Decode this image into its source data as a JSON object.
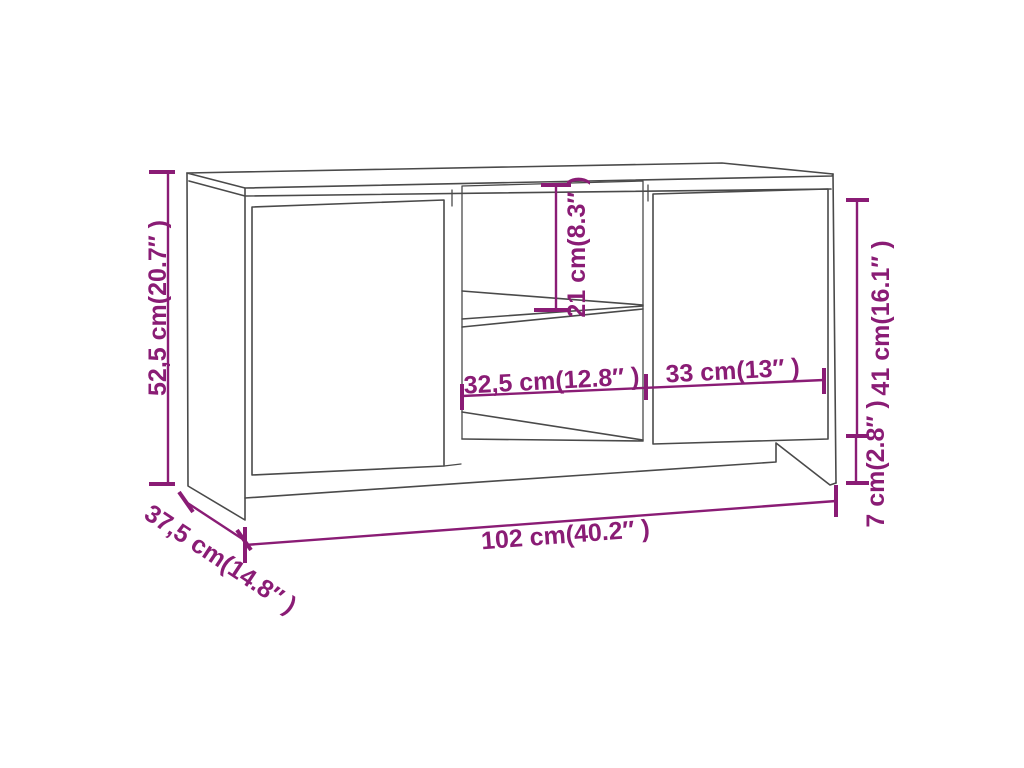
{
  "diagram": {
    "kind": "furniture-dimension-line-drawing",
    "accent_color": "#8A1C75",
    "outline_color": "#4A4A4A",
    "background_color": "#FFFFFF",
    "labels": {
      "height": "52,5 cm(20.7″ )",
      "depth": "37,5 cm(14.8″ )",
      "width": "102 cm(40.2″ )",
      "open_shelf_height": "21 cm(8.3″ )",
      "open_shelf_width": "32,5 cm(12.8″ )",
      "door_width": "33 cm(13″ )",
      "door_height": "41 cm(16.1″ )",
      "plinth_height": "7 cm(2.8″ )"
    }
  }
}
